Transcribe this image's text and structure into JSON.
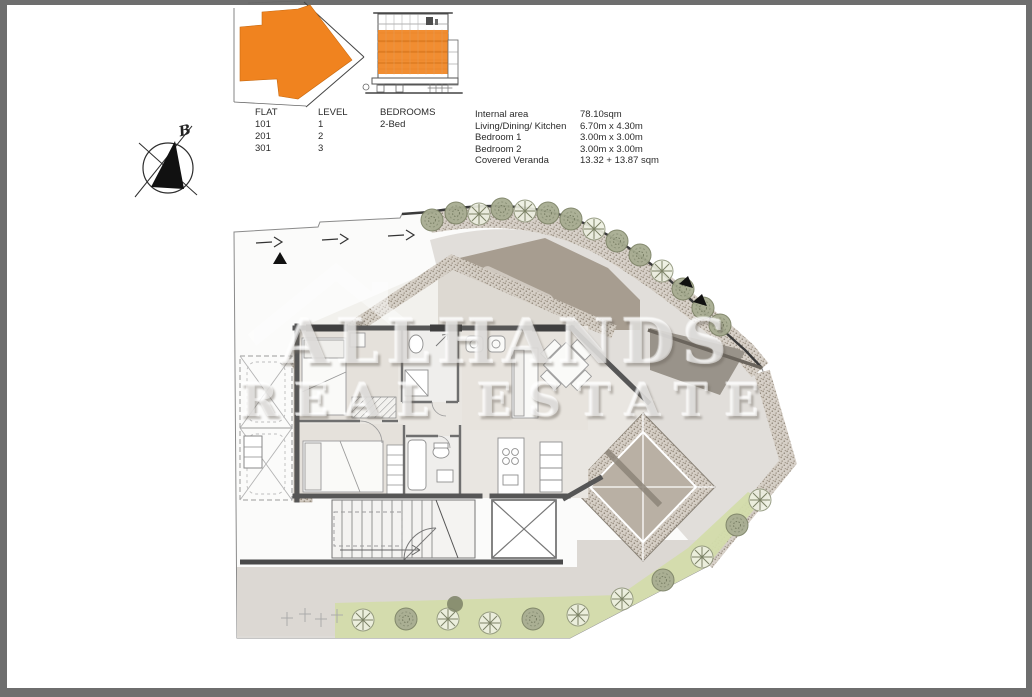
{
  "page": {
    "type": "apartment floor plan sheet",
    "background": "#ffffff",
    "frame_color": "#6e6e6e"
  },
  "colors": {
    "accent_orange": "#F0831F",
    "wall_gray": "#565656",
    "stipple_tan": "#cfc8be",
    "deck_taupe": "#a79d90",
    "landscape_green": "#d3dcab",
    "tree_olive": "#8f957b",
    "ground_gray": "#dcd8d3"
  },
  "unit_table": {
    "headers": [
      "FLAT",
      "LEVEL",
      "BEDROOMS"
    ],
    "rows": [
      [
        "101",
        "1",
        "2-Bed"
      ],
      [
        "201",
        "2",
        ""
      ],
      [
        "301",
        "3",
        ""
      ]
    ]
  },
  "area_table": {
    "rows": [
      {
        "label": "Internal area",
        "value": "78.10sqm"
      },
      {
        "label": "Living/Dining/ Kitchen",
        "value": "6.70m x 4.30m"
      },
      {
        "label": "Bedroom 1",
        "value": "3.00m x 3.00m"
      },
      {
        "label": "Bedroom 2",
        "value": "3.00m x 3.00m"
      },
      {
        "label": "Covered Veranda",
        "value": "13.32 + 13.87 sqm"
      }
    ]
  },
  "compass": {
    "label": "B"
  },
  "watermark": {
    "line1": "ALLHANDS",
    "line2": "REAL ESTATE"
  }
}
